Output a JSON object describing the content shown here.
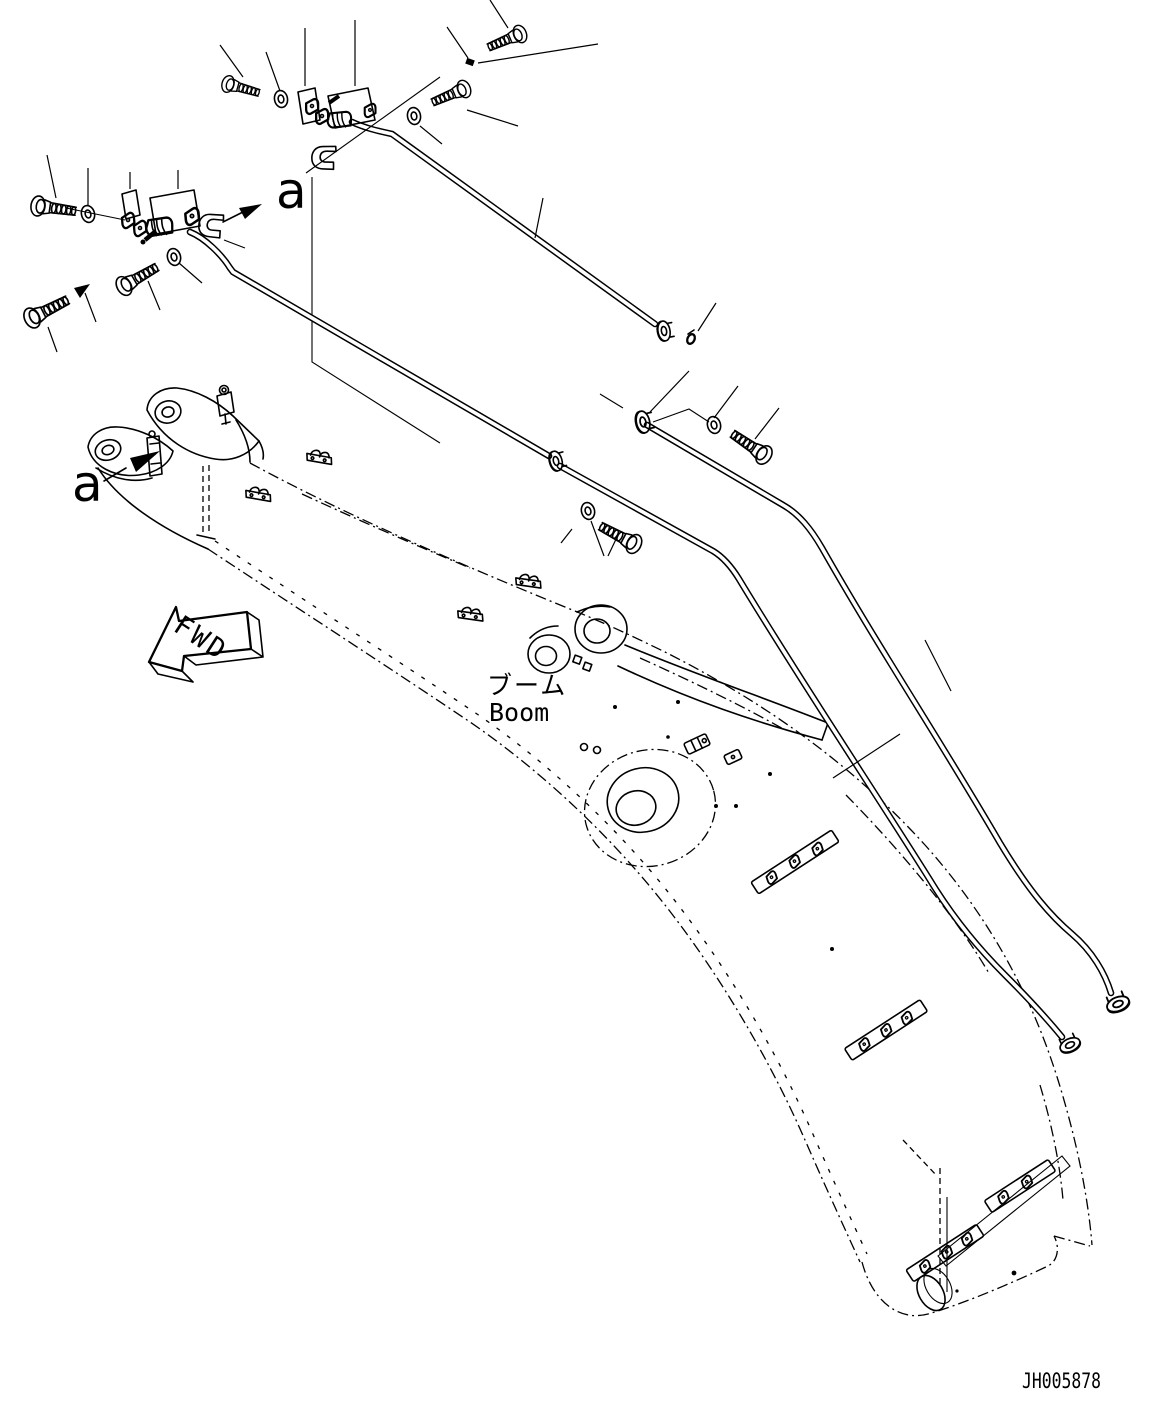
{
  "colors": {
    "ink": "#000000",
    "paper": "#ffffff"
  },
  "labels": {
    "view_arrow_top": "a",
    "view_arrow_front": "a",
    "forward": "FWD",
    "component_jp": "ブーム",
    "component_en": "Boom",
    "drawing_number": "JH005878"
  }
}
